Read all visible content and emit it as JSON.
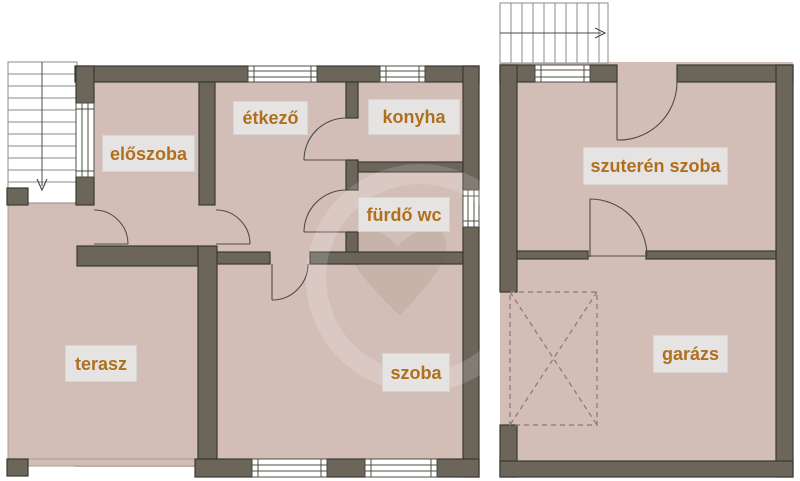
{
  "colors": {
    "wall": "#6b655a",
    "wall_outline": "#3a3933",
    "floor": "#d3beb7",
    "terrace_line": "#a59d95",
    "stair_line": "#8d8b85",
    "window_bg": "#ffffff",
    "window_line": "#4e4c46",
    "door_line": "#4f4c45",
    "parking_dash": "#8d776b",
    "label_bg": "#e6e4e2",
    "label_text": "#b06f1e",
    "wm_dark": "rgba(109,85,73,0.10)",
    "wm_light": "rgba(255,255,255,0.16)"
  },
  "floors": {
    "upper_name": "upper-floor-plan",
    "basement_name": "basement-floor-plan"
  },
  "rooms": [
    {
      "id": "eloszoba",
      "label": "előszoba"
    },
    {
      "id": "etkezo",
      "label": "étkező"
    },
    {
      "id": "konyha",
      "label": "konyha"
    },
    {
      "id": "furdo-wc",
      "label": "fürdő wc"
    },
    {
      "id": "szoba",
      "label": "szoba"
    },
    {
      "id": "terasz",
      "label": "terasz"
    },
    {
      "id": "szuteren-szoba",
      "label": "szuterén szoba"
    },
    {
      "id": "garazs",
      "label": "garázs"
    }
  ]
}
